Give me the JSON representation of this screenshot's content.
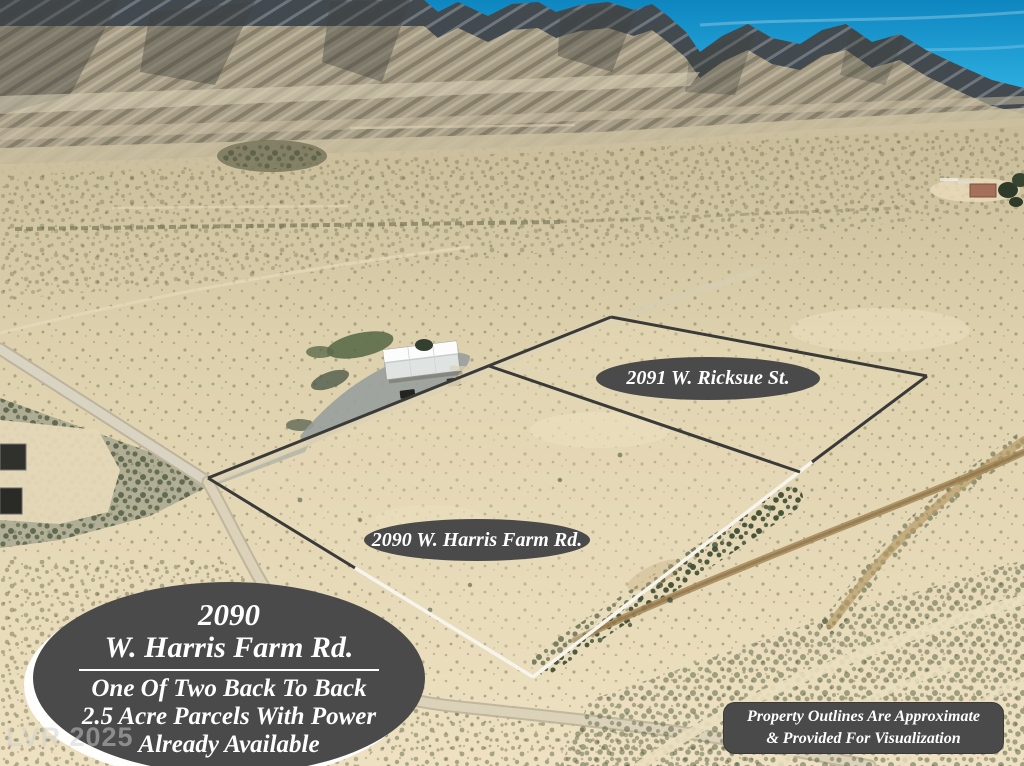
{
  "photo_labels": {
    "upper_parcel": "2091 W. Ricksue St.",
    "lower_parcel": "2090 W. Harris Farm Rd."
  },
  "headline_badge": {
    "address_number": "2090",
    "street": "W. Harris Farm Rd.",
    "tagline_line1": "One Of Two Back To Back",
    "tagline_line2": "2.5 Acre Parcels With Power",
    "tagline_line3": "Already Available"
  },
  "disclaimer": {
    "line1": "Property Outlines Are Approximate",
    "line2": "& Provided For Visualization"
  },
  "watermark": "LVR 2025",
  "colors": {
    "label_background": "#4a4a4a",
    "label_text": "#ffffff",
    "sky": "#1b9ccf",
    "desert": "#e2d5b2",
    "parcel_outline_dark": "#3a3a38",
    "parcel_outline_light": "#f7f4ec"
  }
}
